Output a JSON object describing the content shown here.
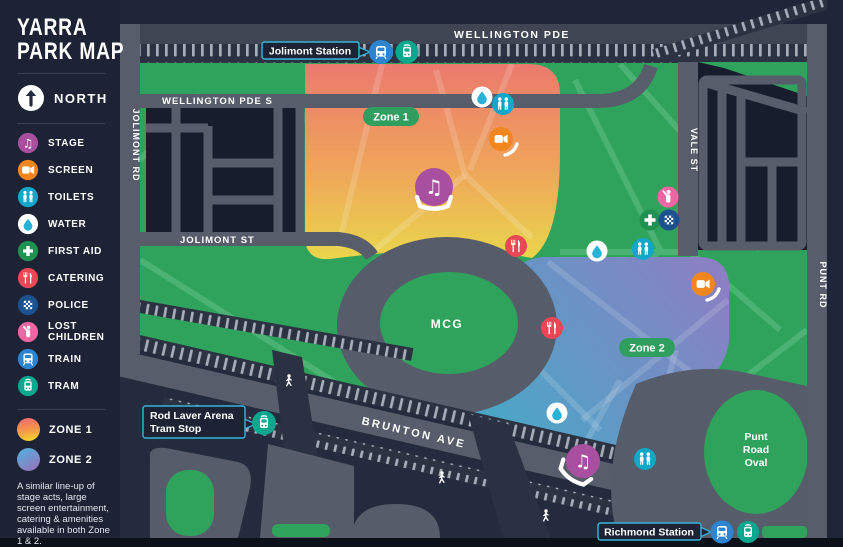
{
  "sidebar": {
    "title_lines": [
      "YARRA",
      "PARK MAP"
    ],
    "north_label": "NORTH",
    "legend": [
      {
        "icon": "stage-icon",
        "label": "STAGE",
        "color": "#a94f9f"
      },
      {
        "icon": "screen-icon",
        "label": "SCREEN",
        "color": "#f1861e"
      },
      {
        "icon": "toilets-icon",
        "label": "TOILETS",
        "color": "#12a6c9"
      },
      {
        "icon": "water-icon",
        "label": "WATER",
        "color": "#ffffff"
      },
      {
        "icon": "first-aid-icon",
        "label": "FIRST AID",
        "color": "#1f9150"
      },
      {
        "icon": "catering-icon",
        "label": "CATERING",
        "color": "#e84855"
      },
      {
        "icon": "police-icon",
        "label": "POLICE",
        "color": "#1c5190"
      },
      {
        "icon": "lost-children-icon",
        "label": "LOST CHILDREN",
        "color": "#ee67a4"
      },
      {
        "icon": "train-icon",
        "label": "TRAIN",
        "color": "#2d85d2"
      },
      {
        "icon": "tram-icon",
        "label": "TRAM",
        "color": "#0aa78f"
      }
    ],
    "zones": [
      {
        "label": "ZONE 1"
      },
      {
        "label": "ZONE 2"
      }
    ],
    "note": "A similar line-up of stage acts, large screen entertainment, catering & amenities available in both Zone 1 & 2."
  },
  "map": {
    "roads": {
      "wellington_pde": "WELLINGTON PDE",
      "wellington_pde_s": "WELLINGTON PDE S",
      "jolimont_rd": "JOLIMONT RD",
      "jolimont_st": "JOLIMONT ST",
      "vale_st": "VALE ST",
      "punt_rd": "PUNT RD",
      "brunton_ave": "BRUNTON AVE"
    },
    "labels": {
      "mcg": "MCG",
      "punt_road_oval_lines": [
        "Punt",
        "Road",
        "Oval"
      ]
    },
    "pills": [
      {
        "label": "Zone 1"
      },
      {
        "label": "Zone 2"
      }
    ],
    "stations": {
      "jolimont": "Jolimont Station",
      "rod_laver_lines": [
        "Rod Laver Arena",
        "Tram Stop"
      ],
      "richmond": "Richmond Station"
    }
  },
  "colors": {
    "park_green": "#2fa35c",
    "road_gray": "#575d6a",
    "block_navy": "#171d2c",
    "zone1_top": "#eb7a6e",
    "zone1_bottom": "#e9d84b",
    "zone2_teal": "#41a8c7",
    "zone2_purple": "#8f7dc3",
    "pin_border_cyan": "#35b6dc",
    "pill_green": "#2f9e5f"
  }
}
